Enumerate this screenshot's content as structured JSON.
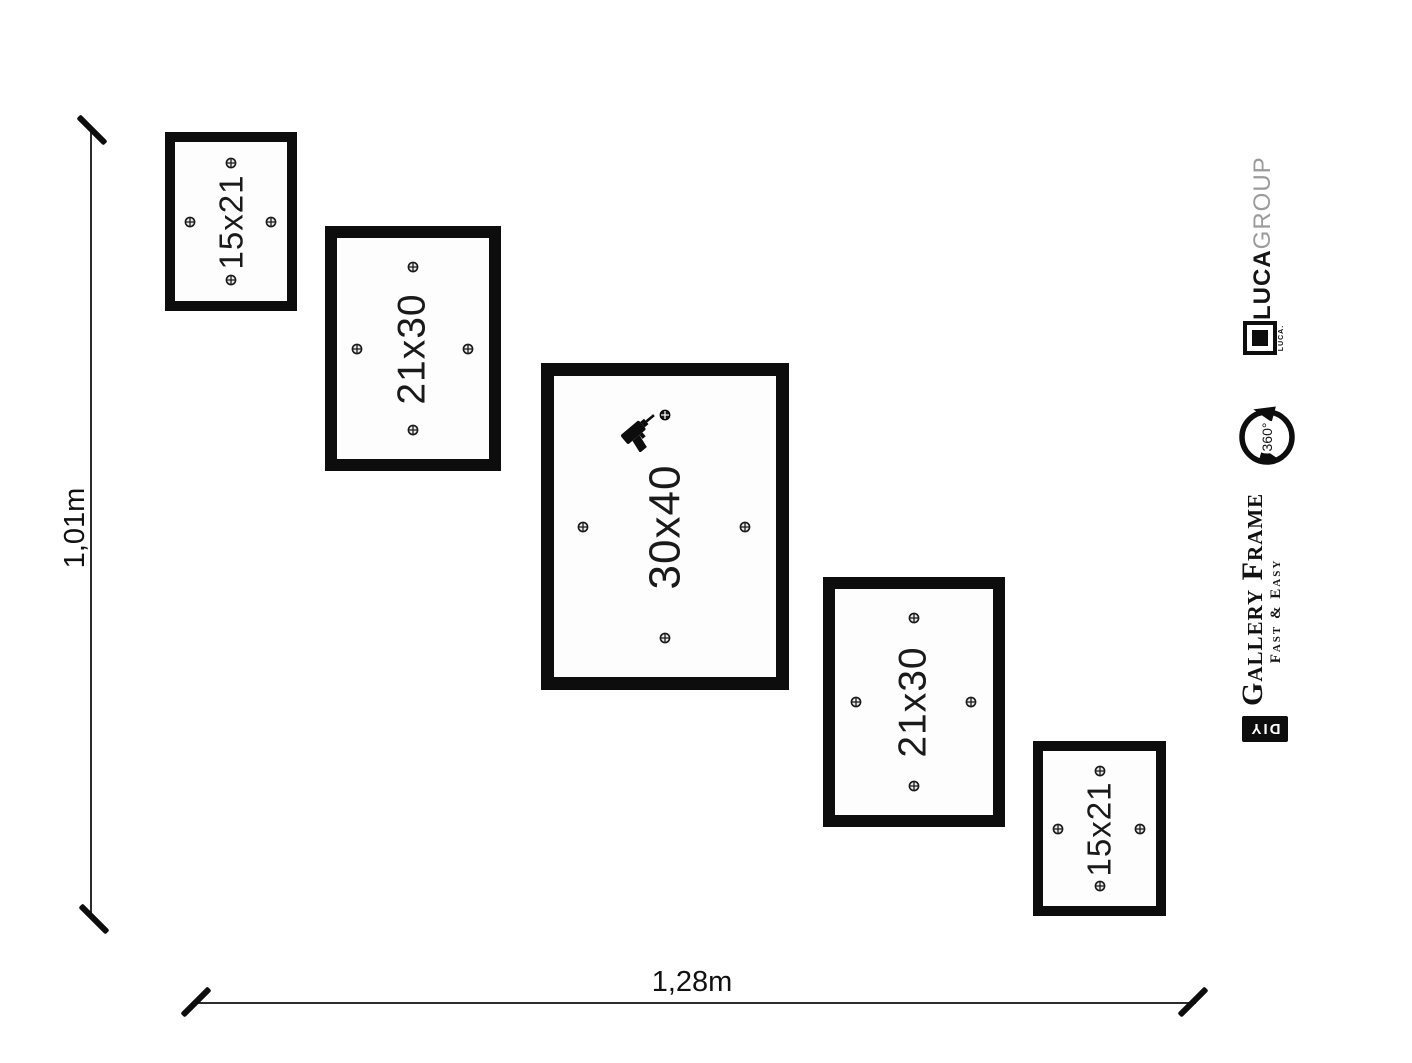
{
  "dimensions": {
    "height_label": "1,01m",
    "width_label": "1,28m"
  },
  "frames": [
    {
      "label": "15x21"
    },
    {
      "label": "21x30"
    },
    {
      "label": "30x40"
    },
    {
      "label": "21x30"
    },
    {
      "label": "15x21"
    }
  ],
  "branding": {
    "brand_bold": "LUCA",
    "brand_light": "GROUP",
    "logo_caption": "LUCA.",
    "rotation_label": "360°",
    "product_title": "Gallery Frame",
    "product_subtitle": "Fast & Easy",
    "diy_label": "DIY"
  },
  "colors": {
    "background": "#ffffff",
    "frame_border": "#0d0d0d",
    "brand_gray": "#9b9b9b"
  }
}
